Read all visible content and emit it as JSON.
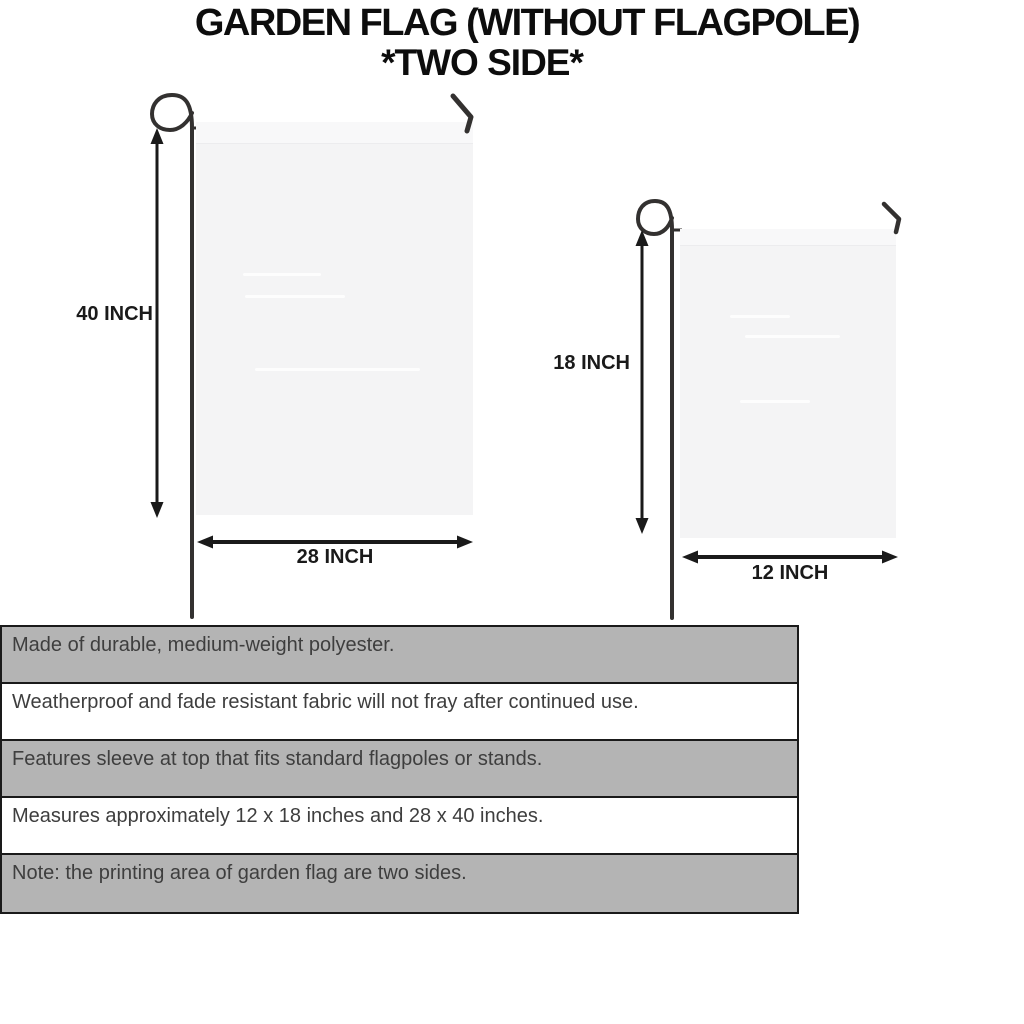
{
  "header": {
    "title": "GARDEN FLAG (WITHOUT FLAGPOLE)",
    "subtitle": "*TWO SIDE*"
  },
  "diagram": {
    "large_flag": {
      "height_label": "40 INCH",
      "width_label": "28 INCH"
    },
    "small_flag": {
      "height_label": "18 INCH",
      "width_label": "12 INCH"
    }
  },
  "features": {
    "rows": [
      "Made of durable, medium-weight polyester.",
      "Weatherproof and fade resistant fabric will not fray after continued use.",
      "Features sleeve at top that fits standard flagpoles or stands.",
      "Measures approximately 12 x 18 inches and 28 x 40 inches.",
      "Note: the printing area of garden flag are two sides."
    ]
  },
  "colors": {
    "title_text": "#0d0d0d",
    "dimension_text": "#1a1a1a",
    "feature_text": "#3e3e3e",
    "row_shaded_bg": "#b4b4b4",
    "row_plain_bg": "#ffffff",
    "table_border": "#1a1a1a",
    "flag_fill": "#f4f4f5",
    "pole_color": "#333130",
    "arrow_color": "#1a1a1a",
    "background": "#ffffff"
  }
}
